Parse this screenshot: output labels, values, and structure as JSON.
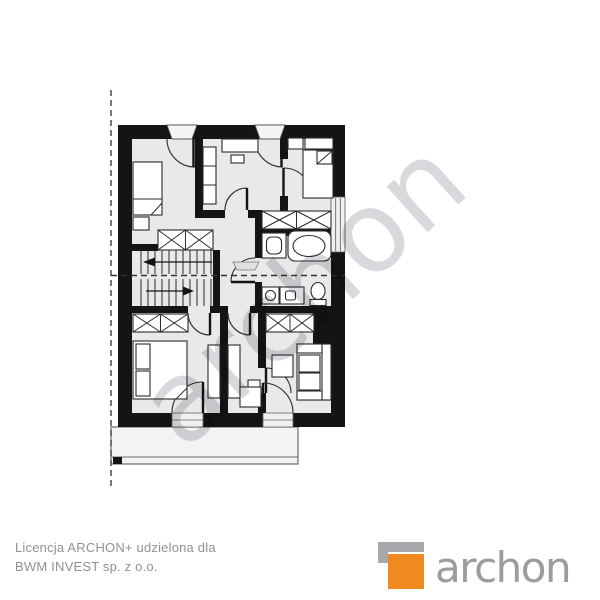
{
  "watermark": {
    "text": "archon",
    "color": "#d9d9dd",
    "rotation_deg": -42
  },
  "footer": {
    "license_line1": "Licencja ARCHON+ udzielona dla",
    "license_line2": "BWM INVEST sp. z o.o.",
    "text_color": "#8e9296"
  },
  "logo": {
    "wordmark": "archon",
    "wordmark_color": "#9b9ca0",
    "square_color": "#f18a1e",
    "bracket_color": "#a8a8ac"
  },
  "plan": {
    "kind": "floor-plan-drawing",
    "wall_color": "#141414",
    "floor_color": "#e9e9e9",
    "terrace_color": "#f3f3f3",
    "icons": [
      "bed",
      "double-bed",
      "wardrobe-x-box",
      "staircase",
      "direction-arrow",
      "bathtub",
      "washbasin",
      "washing-machine",
      "sink-counter",
      "toilet",
      "sofa",
      "table",
      "desk",
      "door-swing",
      "window",
      "dashed-roof-line",
      "terrace"
    ]
  }
}
